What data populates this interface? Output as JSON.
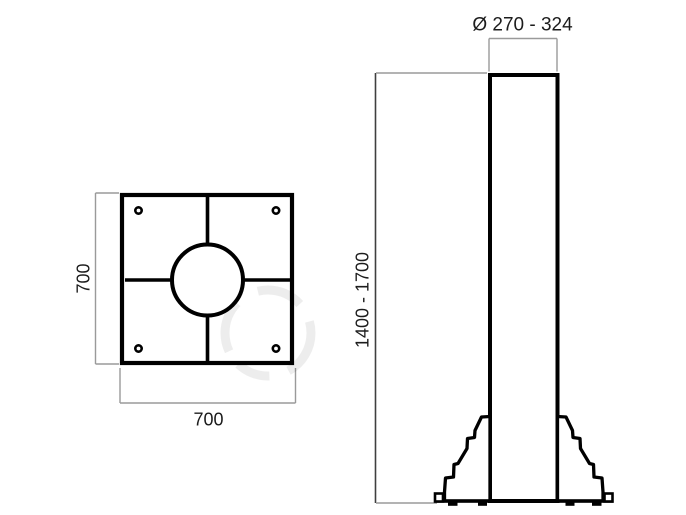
{
  "colors": {
    "background": "#ffffff",
    "drawing_line": "#000000",
    "dimension_line": "#9a9a9a",
    "dimension_line_dark": "#3f3f3f",
    "text": "#1c1c1c"
  },
  "plate_top_view": {
    "height_label": "700",
    "width_label": "700"
  },
  "pole_side_view": {
    "diameter_label": "Ø 270 - 324",
    "height_label": "1400 - 1700"
  }
}
